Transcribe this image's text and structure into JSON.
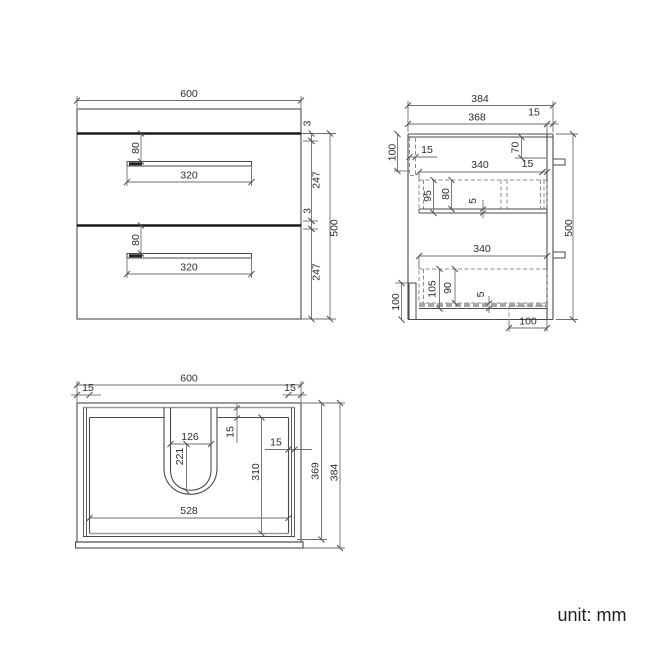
{
  "footer": {
    "unit_label": "unit: mm"
  },
  "front": {
    "width": "600",
    "gap_top": "3",
    "drawer1_height": "247",
    "gap_middle": "3",
    "drawer2_height": "247",
    "total_height": "500",
    "handle1_offset": "80",
    "handle1_length": "320",
    "handle2_offset": "80",
    "handle2_length": "320"
  },
  "side": {
    "total_depth": "384",
    "inner_depth": "368",
    "back_panel_thickness": "15",
    "hang_rail_height": "100",
    "hang_rail_thickness": "15",
    "back_rail_drop": "70",
    "drawer1_depth": "340",
    "drawer1_back_gap": "15",
    "drawer1_front_height": "95",
    "drawer1_inner_height": "80",
    "drawer1_bottom_thickness": "5",
    "total_height": "500",
    "drawer2_depth": "340",
    "drawer2_front_height": "105",
    "drawer2_inner_height": "90",
    "drawer2_bottom_thickness": "5",
    "front_bottom_height": "100",
    "notch_width": "100"
  },
  "plan": {
    "width": "600",
    "left_wall_thickness": "15",
    "right_wall_thickness": "15",
    "cutout_width": "126",
    "cutout_depth": "221",
    "cutout_top_inset": "15",
    "right_inner_gap": "15",
    "inner_depth": "310",
    "inner_width": "528",
    "depth_to_rail": "369",
    "total_depth": "384"
  }
}
